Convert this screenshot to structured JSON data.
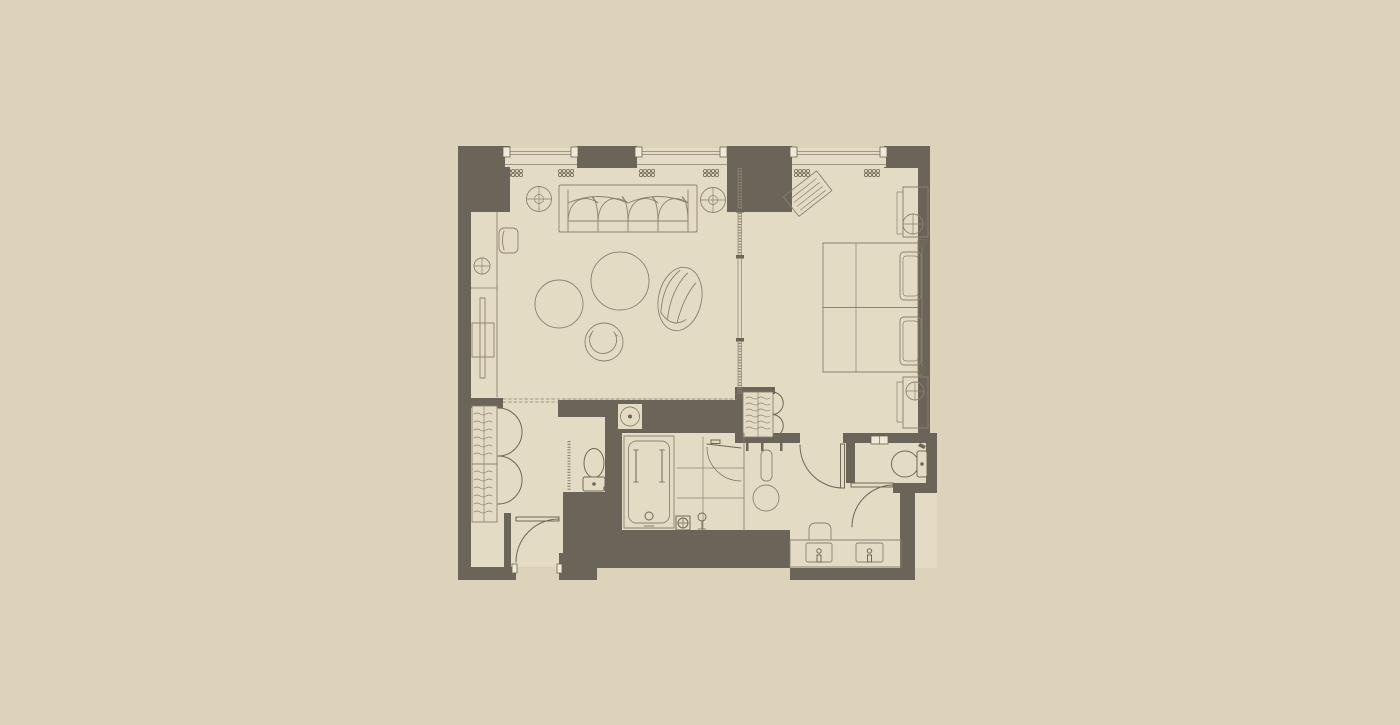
{
  "image": {
    "kind": "architectural-floor-plan",
    "subject": "hotel-suite-plan",
    "width_px": 1400,
    "height_px": 725,
    "visible_text": ""
  },
  "colors": {
    "bg": "#ddd3bb",
    "floor": "#e4dbc5",
    "wall": "#6b6458",
    "line": "#8a8171",
    "fixture": "#6f6756",
    "accent": "#efe9d8"
  },
  "rooms": [
    {
      "name": "living-room"
    },
    {
      "name": "bedroom"
    },
    {
      "name": "entry-hall"
    },
    {
      "name": "wardrobe-closet"
    },
    {
      "name": "water-closet-left"
    },
    {
      "name": "bathtub-room"
    },
    {
      "name": "shower-room"
    },
    {
      "name": "dressing-area"
    },
    {
      "name": "water-closet-right"
    },
    {
      "name": "vanity-area"
    }
  ],
  "symbols": [
    {
      "name": "window",
      "count": 3
    },
    {
      "name": "curtain-scribble",
      "count": 6
    },
    {
      "name": "sliding-glass-partition",
      "count": 1
    },
    {
      "name": "sofa-four-seat",
      "count": 1
    },
    {
      "name": "floor-lamp-crosshair",
      "count": 2
    },
    {
      "name": "coffee-table-round",
      "count": 2
    },
    {
      "name": "tub-chair-round",
      "count": 1
    },
    {
      "name": "swivel-lounge-chair",
      "count": 1
    },
    {
      "name": "tv-console",
      "count": 1
    },
    {
      "name": "side-chair",
      "count": 1
    },
    {
      "name": "table-lamp",
      "count": 1
    },
    {
      "name": "twin-bed",
      "count": 2
    },
    {
      "name": "pillow",
      "count": 2
    },
    {
      "name": "nightstand-with-lamp",
      "count": 2
    },
    {
      "name": "luggage-rack",
      "count": 1
    },
    {
      "name": "bifold-closet",
      "count": 2
    },
    {
      "name": "toilet",
      "count": 2
    },
    {
      "name": "bathtub",
      "count": 1
    },
    {
      "name": "shower-head",
      "count": 1
    },
    {
      "name": "floor-drain",
      "count": 1
    },
    {
      "name": "shower-bench",
      "count": 1
    },
    {
      "name": "round-stool",
      "count": 1
    },
    {
      "name": "vanity-sink",
      "count": 2
    },
    {
      "name": "vanity-stool",
      "count": 1
    },
    {
      "name": "swing-door",
      "count": 4
    },
    {
      "name": "wall-niche-lamp",
      "count": 1
    }
  ]
}
